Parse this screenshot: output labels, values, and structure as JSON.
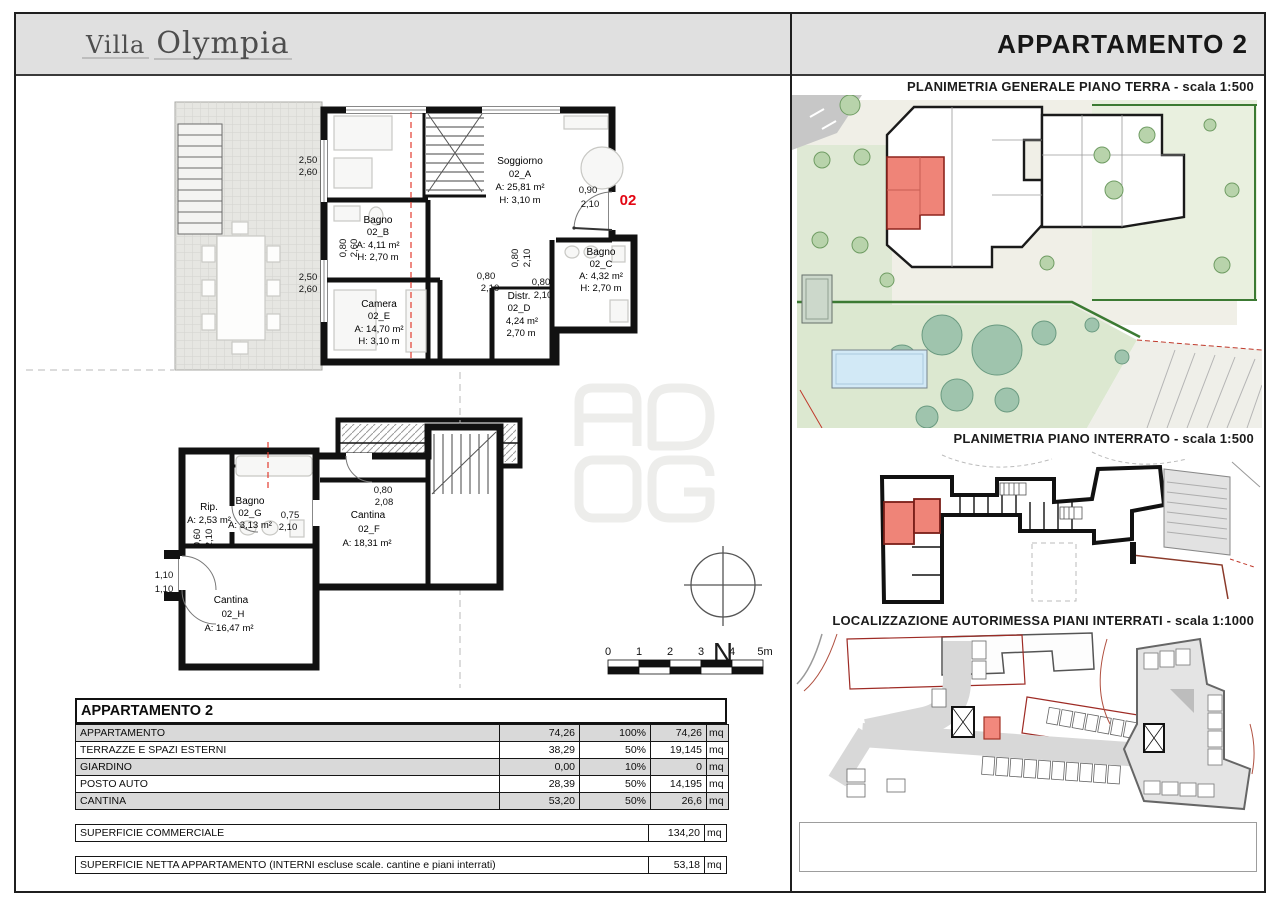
{
  "header": {
    "logo": {
      "line1": "Villa",
      "line2": "Olympia"
    },
    "title": "APPARTAMENTO 2"
  },
  "watermark": {
    "name": "ADOG logo",
    "letters": [
      "A",
      "D",
      "O",
      "G"
    ]
  },
  "compass": {
    "label": "N"
  },
  "scalebar": {
    "labels": [
      "0",
      "1",
      "2",
      "3",
      "4",
      "5m"
    ]
  },
  "plans": {
    "main": {
      "unit_label": "02",
      "rooms": [
        {
          "name": "Soggiorno",
          "code": "02_A",
          "area": "A: 25,81 m²",
          "height": "H: 3,10 m"
        },
        {
          "name": "Bagno",
          "code": "02_B",
          "area": "A: 4,11 m²",
          "height": "H: 2,70 m"
        },
        {
          "name": "Bagno",
          "code": "02_C",
          "area": "A: 4,32 m²",
          "height": "H: 2,70 m"
        },
        {
          "name": "Camera",
          "code": "02_E",
          "area": "A: 14,70 m²",
          "height": "H: 3,10 m"
        },
        {
          "name": "Distr.",
          "code": "02_D",
          "area": "4,24 m²",
          "height": "2,70 m"
        }
      ],
      "dims": [
        {
          "a": "2,50",
          "b": "2,60"
        },
        {
          "a": "2,50",
          "b": "2,60"
        },
        {
          "a": "0,80",
          "b": "2,60"
        },
        {
          "a": "0,90",
          "b": "2,10"
        },
        {
          "a": "0,80",
          "b": "2,10"
        },
        {
          "a": "0,80",
          "b": "2,10"
        },
        {
          "a": "0,80",
          "b": "2,10"
        }
      ]
    },
    "basement": {
      "rooms": [
        {
          "name": "Rip.",
          "code": "",
          "area": "A: 2,53 m²",
          "height": ""
        },
        {
          "name": "Bagno",
          "code": "02_G",
          "area": "A: 3,13 m²",
          "height": ""
        },
        {
          "name": "Cantina",
          "code": "02_F",
          "area": "A: 18,31 m²",
          "height": ""
        },
        {
          "name": "Cantina",
          "code": "02_H",
          "area": "A: 16,47 m²",
          "height": ""
        }
      ],
      "dims": [
        {
          "a": "0,75",
          "b": "2,10"
        },
        {
          "a": "0,80",
          "b": "2,08"
        },
        {
          "a": "0,60",
          "b": "2,10"
        },
        {
          "a": "1,10",
          "b": "1,10"
        }
      ]
    }
  },
  "right_panel": {
    "sections": [
      {
        "title": "PLANIMETRIA GENERALE PIANO TERRA - scala 1:500"
      },
      {
        "title": "PLANIMETRIA PIANO INTERRATO - scala 1:500"
      },
      {
        "title": "LOCALIZZAZIONE AUTORIMESSA PIANI INTERRATI - scala 1:1000"
      }
    ]
  },
  "table": {
    "title": "APPARTAMENTO 2",
    "rows": [
      {
        "label": "APPARTAMENTO",
        "value": "74,26",
        "pct": "100%",
        "computed": "74,26",
        "unit": "mq"
      },
      {
        "label": "TERRAZZE E SPAZI ESTERNI",
        "value": "38,29",
        "pct": "50%",
        "computed": "19,145",
        "unit": "mq"
      },
      {
        "label": "GIARDINO",
        "value": "0,00",
        "pct": "10%",
        "computed": "0",
        "unit": "mq"
      },
      {
        "label": "POSTO AUTO",
        "value": "28,39",
        "pct": "50%",
        "computed": "14,195",
        "unit": "mq"
      },
      {
        "label": "CANTINA",
        "value": "53,20",
        "pct": "50%",
        "computed": "26,6",
        "unit": "mq"
      }
    ],
    "summary": [
      {
        "label": "SUPERFICIE COMMERCIALE",
        "value": "134,20",
        "unit": "mq"
      },
      {
        "label": "SUPERFICIE NETTA APPARTAMENTO (INTERNI escluse scale. cantine e piani interrati)",
        "value": "53,18",
        "unit": "mq"
      }
    ]
  },
  "colors": {
    "accent_red": "#e30613",
    "unit_highlight": "#ef8478",
    "header_gray": "#e0e0e0",
    "table_row_gray": "#d9d9d9",
    "garden_green": "#dce8d0",
    "hedge_green": "#3c7a33",
    "pool_blue": "#d2e9f6"
  }
}
